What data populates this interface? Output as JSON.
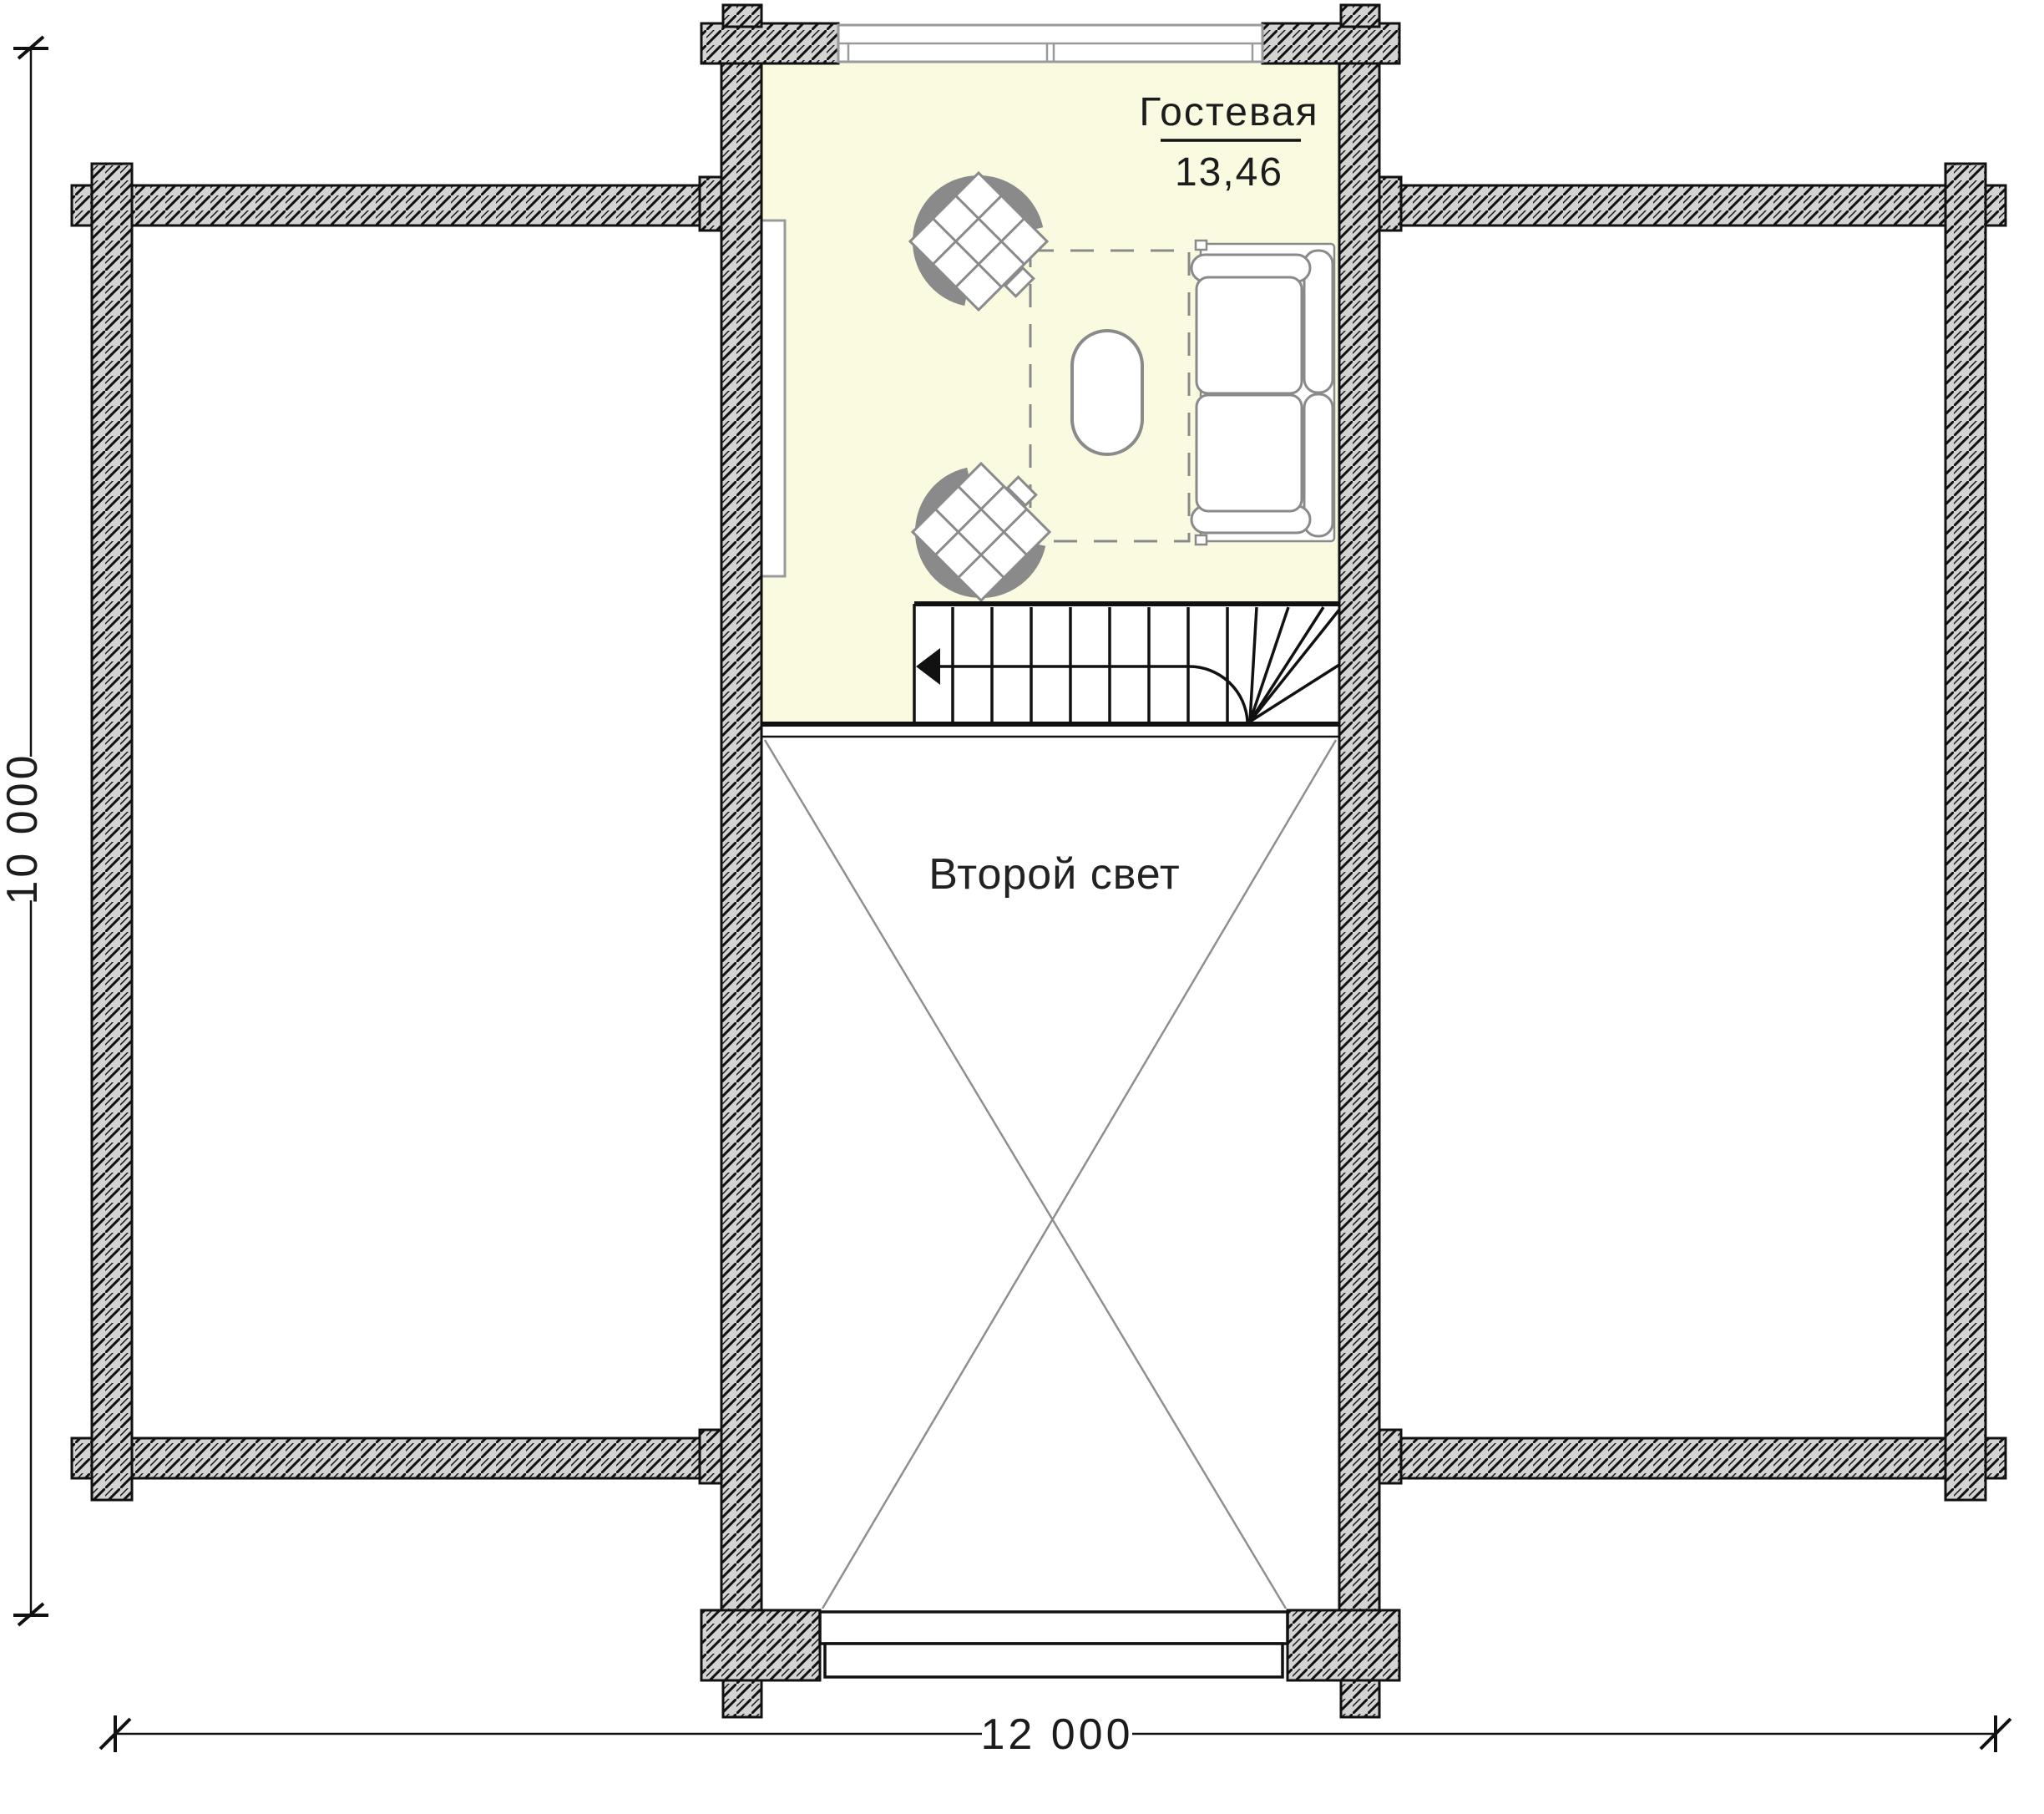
{
  "plan": {
    "title": "Second floor plan (log house)",
    "room": {
      "name": "Гостевая",
      "area": "13,46"
    },
    "void_label": "Второй свет",
    "dim_height": "10 000",
    "dim_width": "12 000",
    "colors": {
      "room_fill": "#fafae1",
      "wall_fill": "#d3d3d3",
      "wall_line": "#111111",
      "furniture": "#8a8a8a",
      "void_line": "#8f8f8f"
    }
  }
}
